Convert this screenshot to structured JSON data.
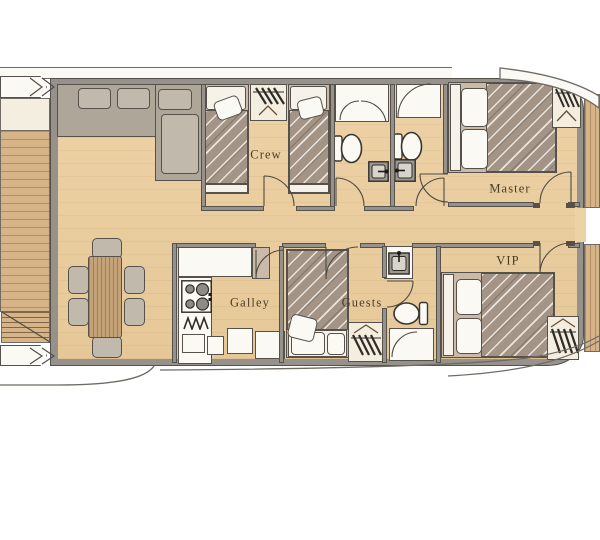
{
  "rooms": {
    "crew": {
      "label": "Crew"
    },
    "master": {
      "label": "Master"
    },
    "vip": {
      "label": "VIP"
    },
    "galley": {
      "label": "Galley"
    },
    "guests": {
      "label": "Guests"
    }
  },
  "icons": [
    "sofa",
    "dining-table",
    "dining-chair",
    "single-bed",
    "double-bed",
    "pillow",
    "wardrobe-hangers",
    "toilet",
    "sink",
    "shower-door",
    "stove-burners",
    "stairs",
    "door-swing",
    "deck-bench"
  ],
  "colors": {
    "floor": "#edd2a6",
    "floor2": "#e6c898",
    "teak": "#d6b488",
    "wall": "#96928b",
    "wall_dark": "#56524b",
    "line": "#6f6b64",
    "white": "#fbf9f4",
    "cream": "#f4eee1",
    "sofa": "#afa69a",
    "cushion": "#c2b9ad",
    "bedding": "#a39485",
    "bed_frame": "#cbbaa7",
    "mattress": "#f6f2e9",
    "wood_table": "#c5a378",
    "fixture_gray": "#9b9791",
    "label": "#4a3a28"
  }
}
